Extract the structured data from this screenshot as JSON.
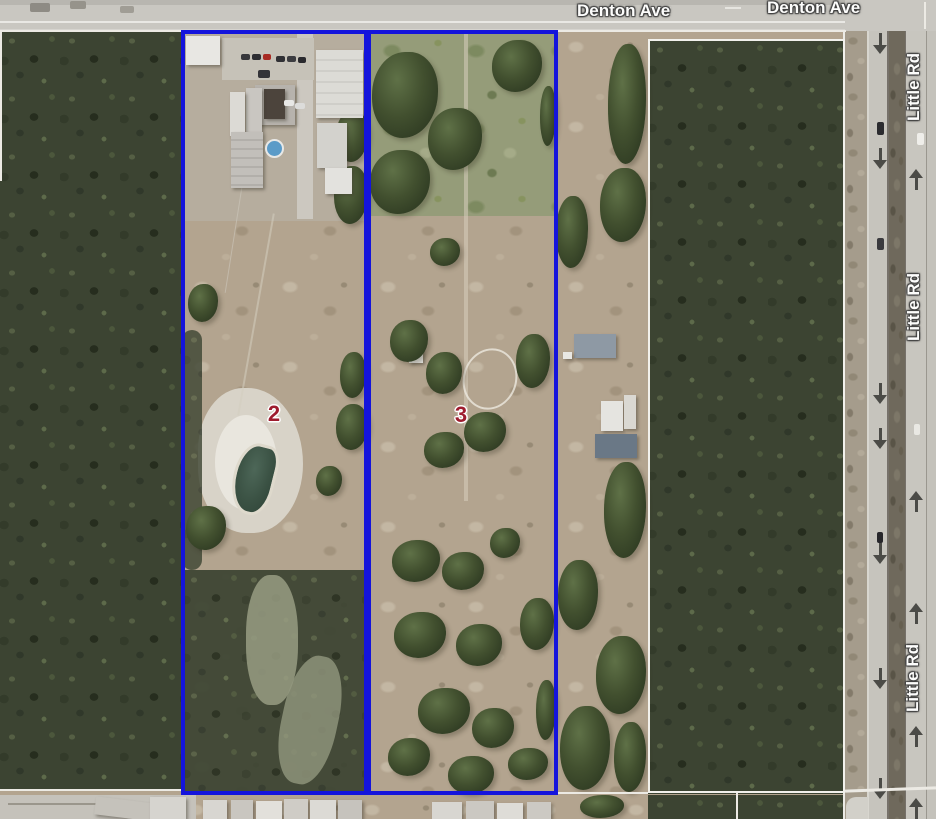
{
  "streets": {
    "denton_ave": {
      "labels": [
        {
          "text": "Denton Ave"
        },
        {
          "text": "Denton Ave"
        }
      ]
    },
    "little_rd": {
      "labels": [
        {
          "text": "Little Rd"
        },
        {
          "text": "Little Rd"
        },
        {
          "text": "Little Rd"
        }
      ]
    }
  },
  "parcels": {
    "highlighted": [
      {
        "number": "2"
      },
      {
        "number": "3"
      }
    ],
    "selected_outline_color": "#1414dc",
    "default_outline_color": "#f2f1ec",
    "label_color": "#9e1c2e"
  }
}
